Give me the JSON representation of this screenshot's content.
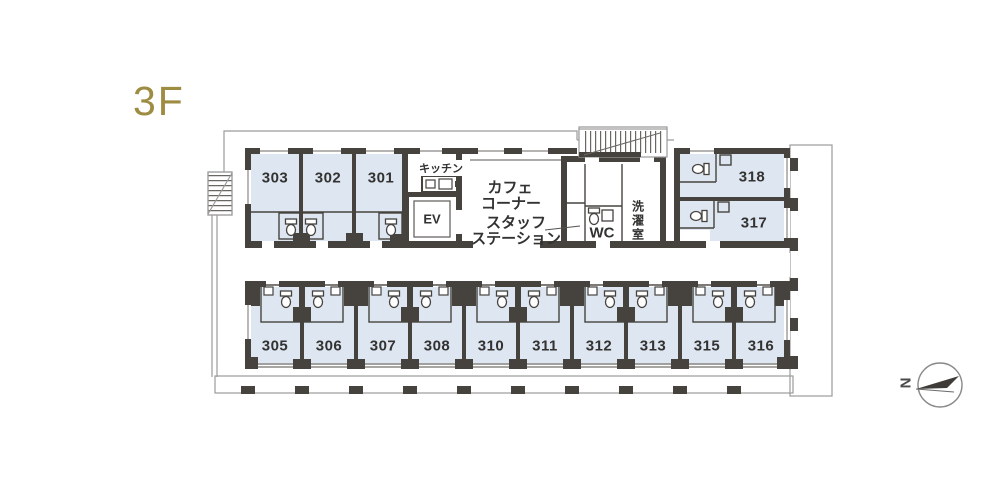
{
  "floor": {
    "label": "3F"
  },
  "rooms": {
    "upper": [
      {
        "number": "303"
      },
      {
        "number": "302"
      },
      {
        "number": "301"
      },
      {
        "number": "318"
      },
      {
        "number": "317"
      }
    ],
    "lower": [
      {
        "number": "305"
      },
      {
        "number": "306"
      },
      {
        "number": "307"
      },
      {
        "number": "308"
      },
      {
        "number": "310"
      },
      {
        "number": "311"
      },
      {
        "number": "312"
      },
      {
        "number": "313"
      },
      {
        "number": "315"
      },
      {
        "number": "316"
      }
    ]
  },
  "facilities": {
    "kitchen": "キッチン",
    "elevator": "EV",
    "cafe_line1": "カフェ",
    "cafe_line2": "コーナー",
    "staff_line1": "スタッフ",
    "staff_line2": "ステーション",
    "wc": "WC",
    "laundry": "洗濯室"
  },
  "compass": {
    "north": "N"
  },
  "colors": {
    "accent_gold": "#9d8c41",
    "room_fill": "#dde6f1",
    "wall": "#46433f",
    "outline": "#9b9b9b"
  }
}
